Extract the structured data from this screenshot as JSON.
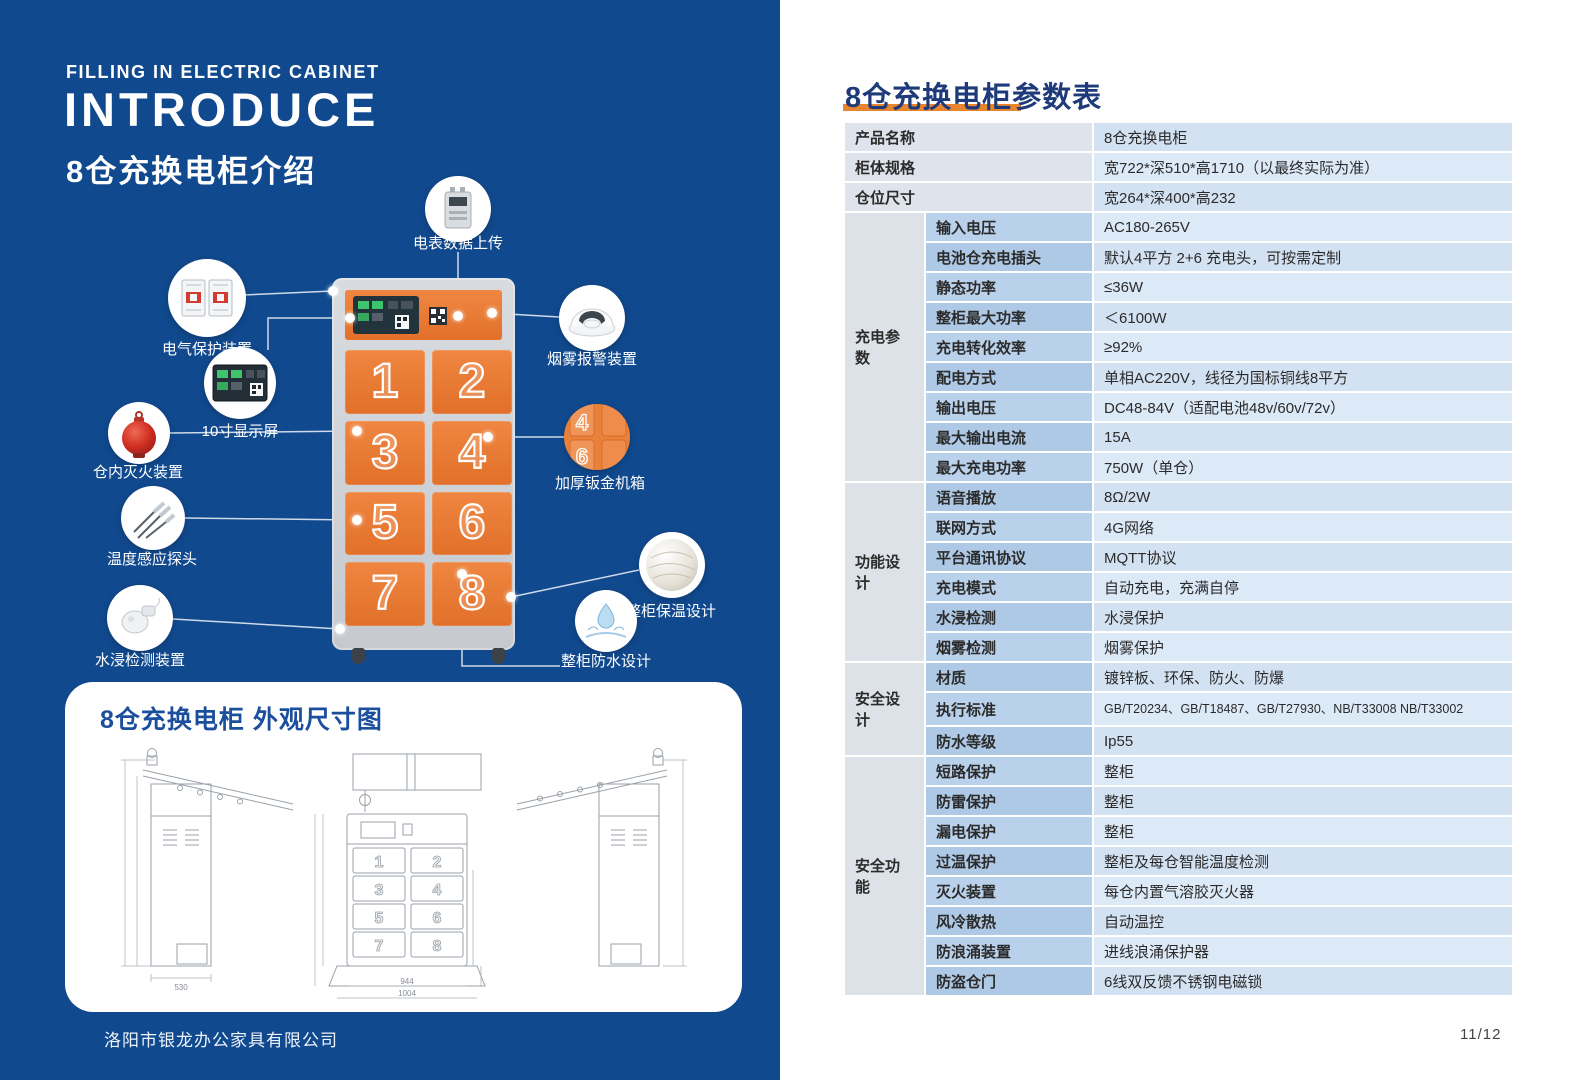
{
  "colors": {
    "panel_blue": "#11498e",
    "door_orange": "#e87a31",
    "accent_orange": "#e8862f",
    "table_navy": "#1e3a7a"
  },
  "intro": {
    "eyebrow": "FILLING IN ELECTRIC CABINET",
    "title": "INTRODUCE",
    "subtitle": "8仓充换电柜介绍"
  },
  "cabinet": {
    "doors": [
      "1",
      "2",
      "3",
      "4",
      "5",
      "6",
      "7",
      "8"
    ]
  },
  "callouts": {
    "meter": "电表数据上传",
    "electric_protection": "电气保护装置",
    "display": "10寸显示屏",
    "fire_extinguisher": "仓内灭火装置",
    "temp_probe": "温度感应探头",
    "water_detect": "水浸检测装置",
    "smoke_alarm": "烟雾报警装置",
    "metal_case": "加厚钣金机箱",
    "insulation": "整柜保温设计",
    "waterproof": "整柜防水设计"
  },
  "dimension_panel": {
    "title": "8仓充换电柜 外观尺寸图",
    "dims": {
      "side_width": "530",
      "front_body_width": "944",
      "front_base_width": "1004"
    }
  },
  "spec_table": {
    "title": "8仓充换电柜参数表",
    "simple_rows": [
      {
        "label": "产品名称",
        "value": "8仓充换电柜"
      },
      {
        "label": "柜体规格",
        "value": "宽722*深510*高1710（以最终实际为准）"
      },
      {
        "label": "仓位尺寸",
        "value": "宽264*深400*高232"
      }
    ],
    "groups": [
      {
        "name": "充电参数",
        "rows": [
          [
            "输入电压",
            "AC180-265V"
          ],
          [
            "电池仓充电插头",
            "默认4平方 2+6 充电头，可按需定制"
          ],
          [
            "静态功率",
            "≤36W"
          ],
          [
            "整柜最大功率",
            "＜6100W"
          ],
          [
            "充电转化效率",
            "≥92%"
          ],
          [
            "配电方式",
            "单相AC220V，线径为国标铜线8平方"
          ],
          [
            "输出电压",
            "DC48-84V（适配电池48v/60v/72v）"
          ],
          [
            "最大输出电流",
            "15A"
          ],
          [
            "最大充电功率",
            "750W（单仓）"
          ]
        ]
      },
      {
        "name": "功能设计",
        "rows": [
          [
            "语音播放",
            "8Ω/2W"
          ],
          [
            "联网方式",
            "4G网络"
          ],
          [
            "平台通讯协议",
            "MQTT协议"
          ],
          [
            "充电模式",
            "自动充电，充满自停"
          ],
          [
            "水浸检测",
            "水浸保护"
          ],
          [
            "烟雾检测",
            "烟雾保护"
          ]
        ]
      },
      {
        "name": "安全设计",
        "rows": [
          [
            "材质",
            "镀锌板、环保、防火、防爆"
          ],
          [
            "执行标准",
            "GB/T20234、GB/T18487、GB/T27930、NB/T33008 NB/T33002"
          ],
          [
            "防水等级",
            "Ip55"
          ]
        ]
      },
      {
        "name": "安全功能",
        "rows": [
          [
            "短路保护",
            "整柜"
          ],
          [
            "防雷保护",
            "整柜"
          ],
          [
            "漏电保护",
            "整柜"
          ],
          [
            "过温保护",
            "整柜及每仓智能温度检测"
          ],
          [
            "灭火装置",
            "每仓内置气溶胶灭火器"
          ],
          [
            "风冷散热",
            "自动温控"
          ],
          [
            "防浪涌装置",
            "进线浪涌保护器"
          ],
          [
            "防盗仓门",
            "6线双反馈不锈钢电磁锁"
          ]
        ]
      }
    ]
  },
  "footer": {
    "company": "洛阳市银龙办公家具有限公司",
    "page_number": "11/12"
  }
}
